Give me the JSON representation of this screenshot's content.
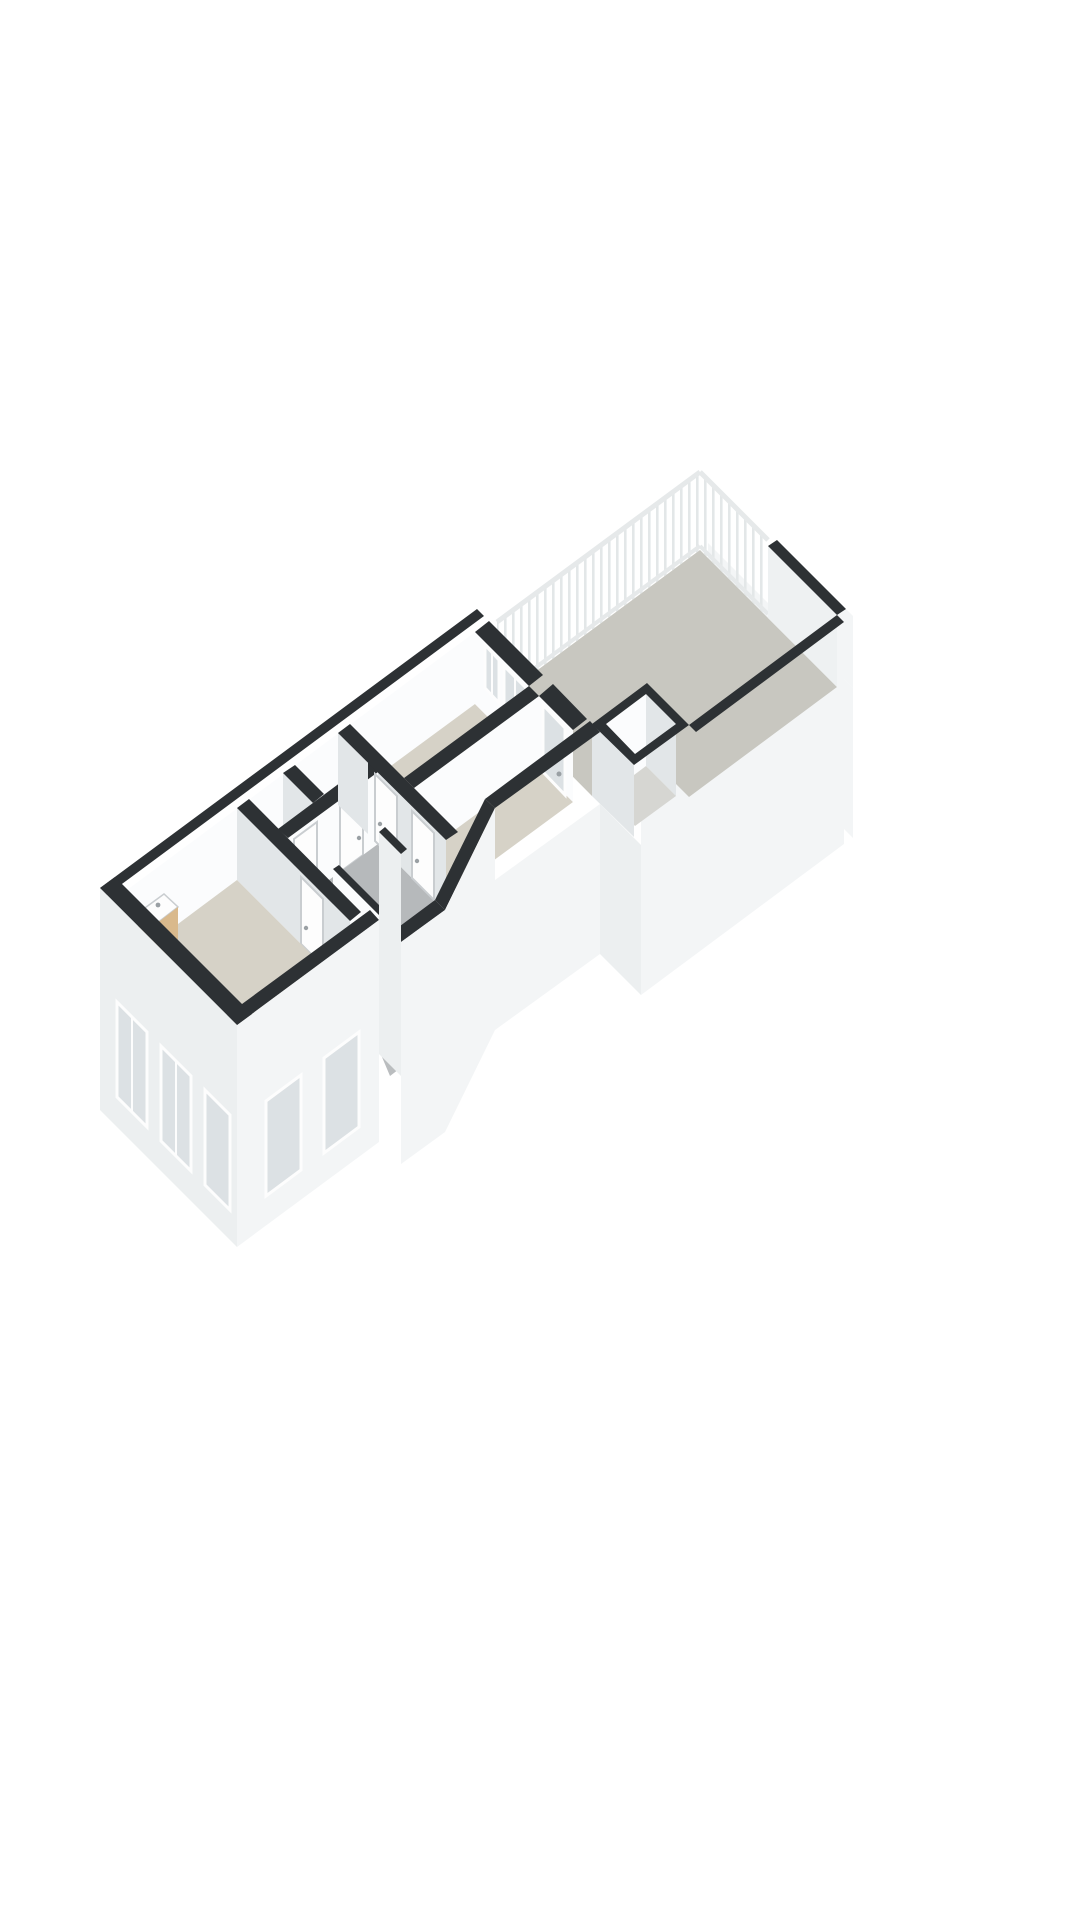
{
  "image": {
    "kind": "3d-floor-plan-render",
    "background": "#ffffff"
  },
  "colors": {
    "cutWall": "#2d3134",
    "faceBright": "#fbfcfd",
    "faceShade": "#e2e6e8",
    "faceMid": "#eef1f2",
    "facade": "#f3f5f6",
    "facadeShade": "#eceff0",
    "floorRoom": "#d6d2c7",
    "floorLight": "#e9e8e4",
    "floorHall": "#b6b9bb",
    "floorTerrace": "#c8c7c0",
    "floorBox": "#d6d6d2",
    "glass": "#dce1e4",
    "frame": "#fdfdfd",
    "frameOutline": "#c9cdd0",
    "railing": "#e3e7e8",
    "railingRail": "#e6e9ea",
    "ramp": "#babdbf",
    "rampLine": "#d2d5d6",
    "wood": "#d9b98c",
    "woodShade": "#c6a678",
    "metal": "#9aa0a4",
    "background": "#ffffff"
  },
  "rooms": [
    {
      "name": "terrace"
    },
    {
      "name": "bedroom"
    },
    {
      "name": "bedroom-2"
    },
    {
      "name": "hallway"
    },
    {
      "name": "living-room"
    },
    {
      "name": "toilet"
    },
    {
      "name": "closet"
    },
    {
      "name": "stairwell"
    },
    {
      "name": "storage-box"
    }
  ],
  "features": [
    "balustrade-railing",
    "glazed-terrace-door",
    "terrace-window",
    "staircase-down",
    "vanity-cabinet",
    "hand-basin",
    "interior-doors",
    "facade-windows"
  ]
}
